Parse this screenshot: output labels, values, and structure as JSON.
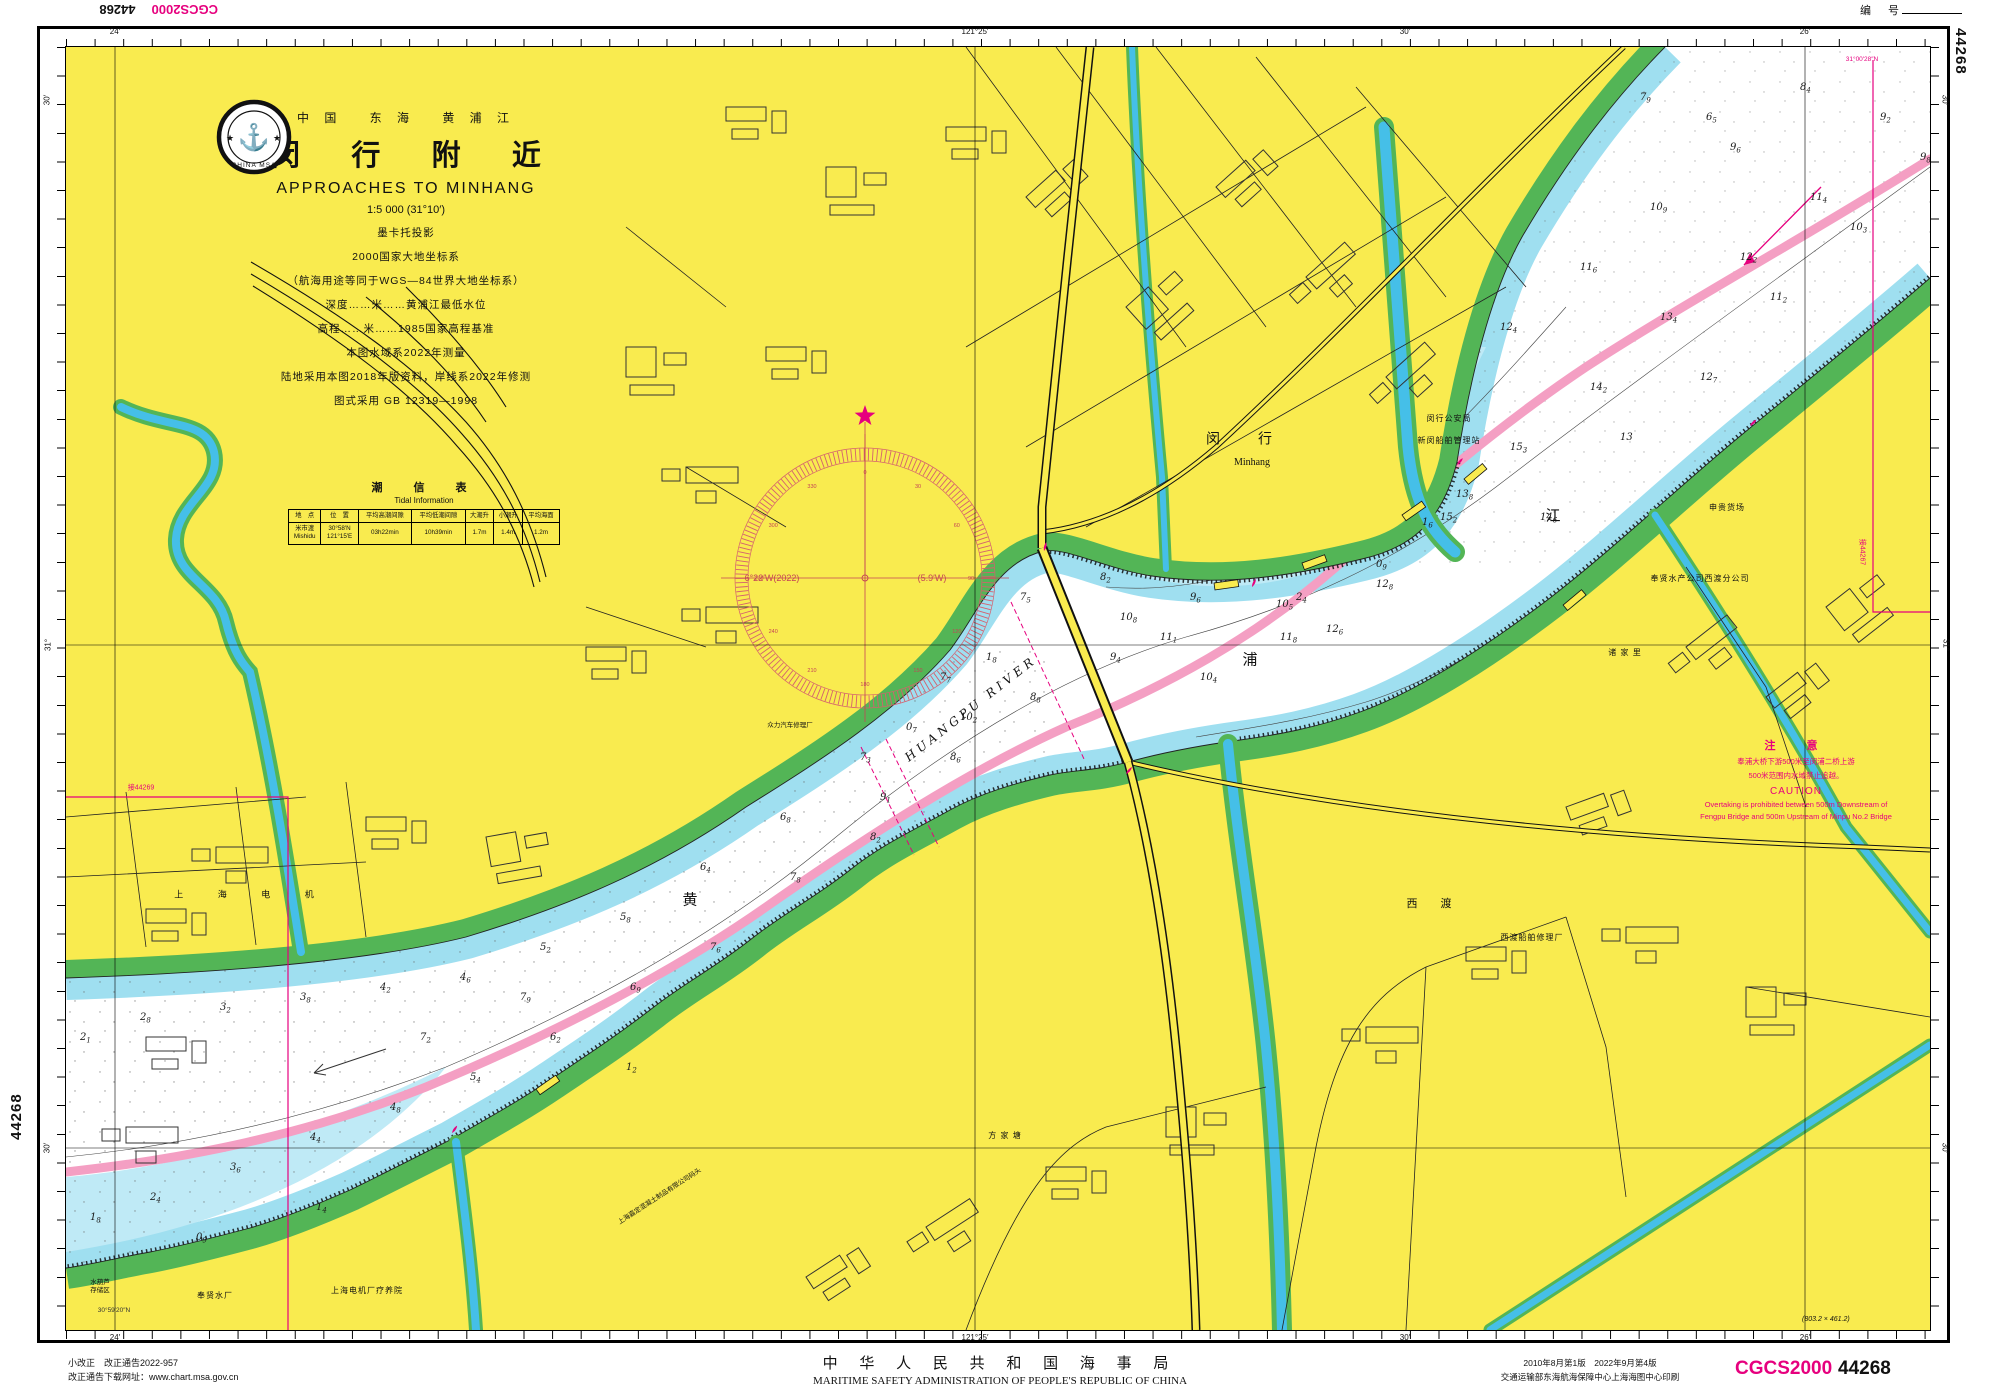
{
  "header": {
    "flipped_cgcs": "CGCS2000",
    "flipped_no": "44268",
    "serial_label": "编　号",
    "right_edge_code": "44268",
    "left_edge_code": "44268"
  },
  "title_block": {
    "logo_text": "CHINA MSA",
    "country_line": "中 国　 东 海　 黄 浦 江",
    "title_cn": "闵 行 附 近",
    "title_en": "APPROACHES TO MINHANG",
    "scale_line": "1:5 000 (31°10′)",
    "lines": [
      "墨卡托投影",
      "2000国家大地坐标系",
      "（航海用途等同于WGS—84世界大地坐标系）",
      "深度……米……黄浦江最低水位",
      "高程……米……1985国家高程基准",
      "本图水域系2022年测量",
      "陆地采用本图2018年版资料，岸线系2022年修测",
      "图式采用 GB 12319—1998"
    ]
  },
  "tide_table": {
    "title_cn": "潮　信　表",
    "title_en": "Tidal  Information",
    "headers": [
      "地　点",
      "位　置",
      "平均高潮间隙",
      "平均低潮间隙",
      "大潮升",
      "小潮升",
      "平均海面"
    ],
    "row": [
      "米市渡\nMishidu",
      "30°58′N\n121°15′E",
      "03h22min",
      "10h39min",
      "1.7m",
      "1.4m",
      "1.2m"
    ]
  },
  "caution": {
    "title_cn": "注　意",
    "cn1": "奉浦大桥下游500米至闵浦二桥上游",
    "cn2": "500米范围内水域禁止追越。",
    "title_en": "CAUTION",
    "en1": "Overtaking is prohibited between 500m Downstream of",
    "en2": "Fengpu Bridge and 500m Upstream of Minpu No.2 Bridge"
  },
  "compass": {
    "var_left": "6°22′W(2022)",
    "var_right": "(5.9′W)"
  },
  "graticule": {
    "top": [
      {
        "x": 115,
        "t": "24′"
      },
      {
        "x": 975,
        "t": "121°25′"
      },
      {
        "x": 1405,
        "t": "30′"
      },
      {
        "x": 1805,
        "t": "26′"
      }
    ],
    "bottom": [
      {
        "x": 115,
        "t": "24′"
      },
      {
        "x": 975,
        "t": "121°25′"
      },
      {
        "x": 1405,
        "t": "30′"
      },
      {
        "x": 1805,
        "t": "26′"
      }
    ],
    "left": [
      {
        "y": 100,
        "t": "30′"
      },
      {
        "y": 645,
        "t": "31°"
      },
      {
        "y": 1148,
        "t": "30′"
      }
    ],
    "right": [
      {
        "y": 100,
        "t": "30′"
      },
      {
        "y": 645,
        "t": "31°"
      },
      {
        "y": 1148,
        "t": "30′"
      }
    ]
  },
  "labels": [
    {
      "x": 1179,
      "y": 393,
      "t": "闵　行",
      "c": "town"
    },
    {
      "x": 1186,
      "y": 416,
      "t": "Minhang",
      "c": "town-en"
    },
    {
      "x": 1383,
      "y": 372,
      "t": "闵行公安局",
      "c": "s"
    },
    {
      "x": 1383,
      "y": 394,
      "t": "新闵船舶管理站",
      "c": "s"
    },
    {
      "x": 1661,
      "y": 461,
      "t": "申贵货场",
      "c": "s"
    },
    {
      "x": 1634,
      "y": 532,
      "t": "奉贤水产公司西渡分公司",
      "c": "s"
    },
    {
      "x": 1559,
      "y": 606,
      "t": "诸 家 里",
      "c": "s"
    },
    {
      "x": 1366,
      "y": 858,
      "t": "西　渡",
      "c": "town2"
    },
    {
      "x": 1466,
      "y": 891,
      "t": "西渡船舶修理厂",
      "c": "s"
    },
    {
      "x": 939,
      "y": 1089,
      "t": "方 家 塘",
      "c": "s"
    },
    {
      "x": 149,
      "y": 1249,
      "t": "奉贤水厂",
      "c": "s"
    },
    {
      "x": 301,
      "y": 1244,
      "t": "上海电机厂疗养院",
      "c": "s"
    },
    {
      "x": 34,
      "y": 1240,
      "t": "水葫芦\n存储区",
      "c": "xs"
    },
    {
      "x": 186,
      "y": 848,
      "t": "上 海 电 机",
      "c": "spread"
    },
    {
      "x": 724,
      "y": 679,
      "t": "众力汽车修理厂",
      "c": "xs"
    },
    {
      "x": 594,
      "y": 1150,
      "t": "上海嘉定混凝土制品有限公司码头",
      "c": "xs",
      "r": -33
    },
    {
      "x": 624,
      "y": 853,
      "t": "黄",
      "c": "rc"
    },
    {
      "x": 1184,
      "y": 613,
      "t": "浦",
      "c": "rc"
    },
    {
      "x": 1487,
      "y": 469,
      "t": "江",
      "c": "rc"
    },
    {
      "x": 905,
      "y": 662,
      "t": "HUANGPU  RIVER",
      "c": "ren",
      "r": -38
    },
    {
      "x": 75,
      "y": 742,
      "t": "接44269",
      "c": "adj"
    },
    {
      "x": 1795,
      "y": 505,
      "t": "接44267",
      "c": "adj",
      "r": 90
    },
    {
      "x": 48,
      "y": 1264,
      "t": "30°59′20″N",
      "c": "tiny"
    },
    {
      "x": 1796,
      "y": 13,
      "t": "31°00′28″N",
      "c": "tinyM"
    }
  ],
  "soundings": [
    [
      1814,
      73,
      "9.2"
    ],
    [
      1734,
      43,
      "8.4"
    ],
    [
      1744,
      153,
      "11.4"
    ],
    [
      1664,
      103,
      "9.6"
    ],
    [
      1674,
      213,
      "12.2"
    ],
    [
      1584,
      163,
      "10.9"
    ],
    [
      1594,
      273,
      "13.4"
    ],
    [
      1514,
      223,
      "11.6"
    ],
    [
      1524,
      343,
      "14.2"
    ],
    [
      1434,
      283,
      "12.4"
    ],
    [
      1444,
      403,
      "15.3"
    ],
    [
      1390,
      450,
      "13.8"
    ],
    [
      1374,
      473,
      "15.2"
    ],
    [
      1310,
      540,
      "12.8"
    ],
    [
      1260,
      585,
      "12.6"
    ],
    [
      1210,
      560,
      "10.5"
    ],
    [
      1214,
      593,
      "11.8"
    ],
    [
      1124,
      553,
      "9.6"
    ],
    [
      1134,
      633,
      "10.4"
    ],
    [
      1034,
      533,
      "8.2"
    ],
    [
      1044,
      613,
      "9.4"
    ],
    [
      954,
      553,
      "7.5"
    ],
    [
      964,
      653,
      "8.8"
    ],
    [
      874,
      633,
      "7.7"
    ],
    [
      884,
      713,
      "8.6"
    ],
    [
      794,
      713,
      "7.3"
    ],
    [
      804,
      793,
      "8.2"
    ],
    [
      714,
      773,
      "6.8"
    ],
    [
      724,
      833,
      "7.8"
    ],
    [
      634,
      823,
      "6.4"
    ],
    [
      644,
      903,
      "7.6"
    ],
    [
      554,
      873,
      "5.8"
    ],
    [
      564,
      943,
      "6.9"
    ],
    [
      474,
      903,
      "5.2"
    ],
    [
      484,
      993,
      "6.2"
    ],
    [
      394,
      933,
      "4.6"
    ],
    [
      404,
      1033,
      "5.4"
    ],
    [
      314,
      943,
      "4.2"
    ],
    [
      324,
      1063,
      "4.8"
    ],
    [
      234,
      953,
      "3.8"
    ],
    [
      244,
      1093,
      "4.4"
    ],
    [
      154,
      963,
      "3.2"
    ],
    [
      164,
      1123,
      "3.6"
    ],
    [
      74,
      973,
      "2.8"
    ],
    [
      84,
      1153,
      "2.4"
    ],
    [
      14,
      993,
      "2.1"
    ],
    [
      24,
      1173,
      "1.8"
    ],
    [
      354,
      993,
      "7.2"
    ],
    [
      454,
      953,
      "7.9"
    ],
    [
      814,
      753,
      "9.1"
    ],
    [
      894,
      673,
      "10.2"
    ],
    [
      1054,
      573,
      "10.8"
    ],
    [
      1094,
      593,
      "11.1"
    ],
    [
      1474,
      473,
      "14.6"
    ],
    [
      1554,
      393,
      "13"
    ],
    [
      1634,
      333,
      "12.7"
    ],
    [
      1704,
      253,
      "11.2"
    ],
    [
      1784,
      183,
      "10.3"
    ],
    [
      1854,
      113,
      "9.8"
    ],
    [
      1574,
      53,
      "7.9"
    ],
    [
      1640,
      73,
      "6.5"
    ],
    [
      1356,
      478,
      "1.6"
    ],
    [
      1310,
      520,
      "0.9"
    ],
    [
      1230,
      553,
      "2.4"
    ],
    [
      920,
      613,
      "1.8"
    ],
    [
      840,
      683,
      "0.7"
    ],
    [
      250,
      1163,
      "1.4"
    ],
    [
      130,
      1193,
      "0.9"
    ],
    [
      560,
      1023,
      "1.2"
    ]
  ],
  "footer": {
    "left1": "小改正　改正通告2022-957",
    "left2": "改正通告下载网址：www.chart.msa.gov.cn",
    "center_cn": "中 华 人 民 共 和 国 海 事 局",
    "center_en": "MARITIME  SAFETY  ADMINISTRATION  OF  PEOPLE'S  REPUBLIC  OF  CHINA",
    "right1": "2010年8月第1版　2022年9月第4版",
    "right2": "交通运输部东海航海保障中心上海海图中心印刷",
    "cgcs": "CGCS2000",
    "chart_no": "44268",
    "dims": "(803.2 × 461.2)"
  }
}
